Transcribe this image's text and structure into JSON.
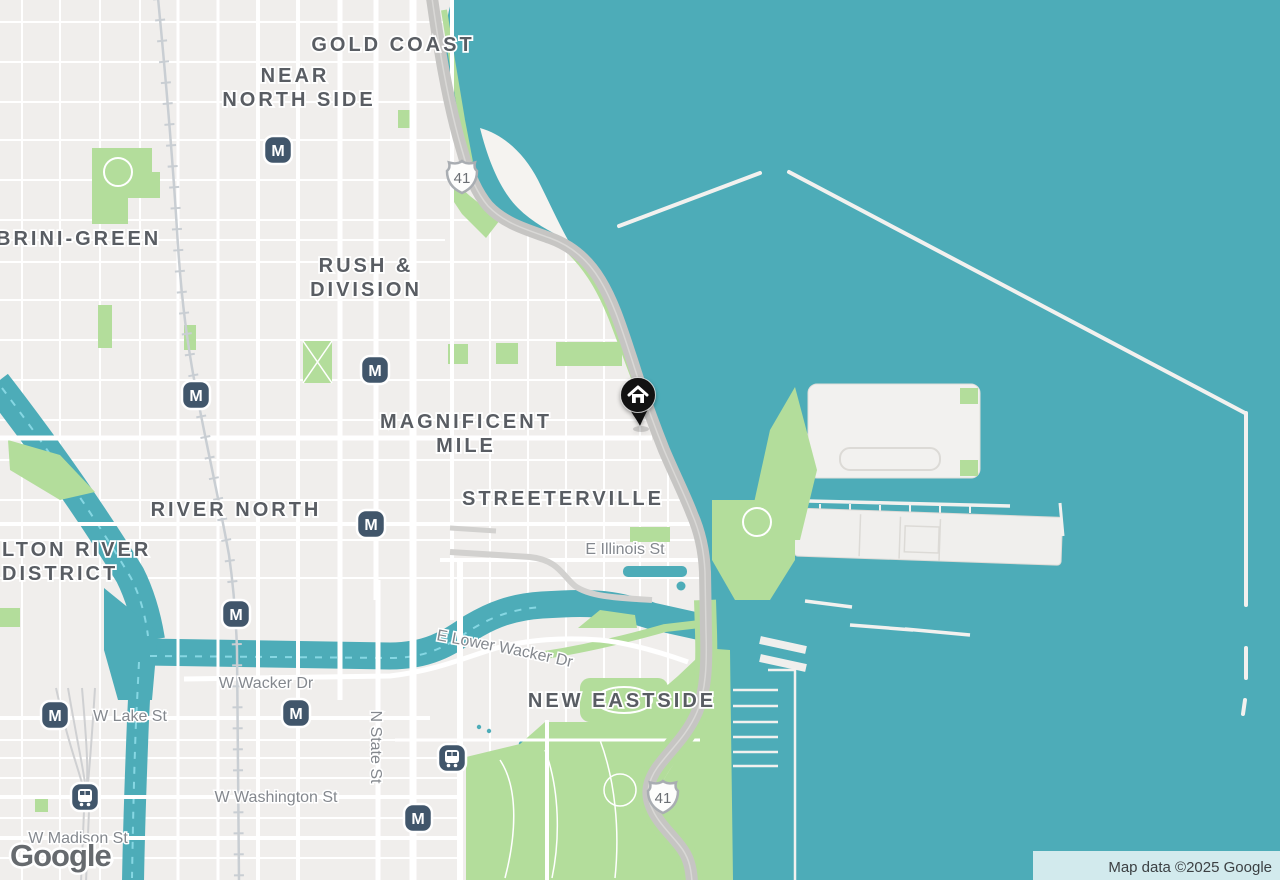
{
  "labels": {
    "gold_coast": "GOLD COAST",
    "near_north_line1": "NEAR",
    "near_north_line2": "NORTH SIDE",
    "cabrini_green_partial": "BRINI-GREEN",
    "rush_division_line1": "RUSH &",
    "rush_division_line2": "DIVISION",
    "magnificent_mile_line1": "MAGNIFICENT",
    "magnificent_mile_line2": "MILE",
    "river_north": "RIVER NORTH",
    "fulton_river_partial_line1": "LTON RIVER",
    "fulton_river_partial_line2": "DISTRICT",
    "streeterville": "STREETERVILLE",
    "new_eastside": "NEW EASTSIDE"
  },
  "streets": {
    "e_illinois": "E Illinois St",
    "e_lower_wacker": "E Lower Wacker Dr",
    "w_wacker": "W Wacker Dr",
    "w_lake": "W Lake St",
    "w_washington": "W Washington St",
    "w_madison": "W Madison St",
    "n_state": "N State St"
  },
  "markers": {
    "metro_label": "M",
    "route_shield": "41"
  },
  "footer": {
    "logo": "Google",
    "attribution": "Map data ©2025 Google"
  },
  "colors": {
    "water": "#4dacb8",
    "water_dash": "#86d7e3",
    "land": "#f0eeec",
    "park": "#b3dd9b",
    "road_major": "#c6c5c3",
    "transit_icon": "#41566b",
    "marker": "#121212",
    "neighborhood_label": "#595d63",
    "street_label": "#84888e"
  }
}
